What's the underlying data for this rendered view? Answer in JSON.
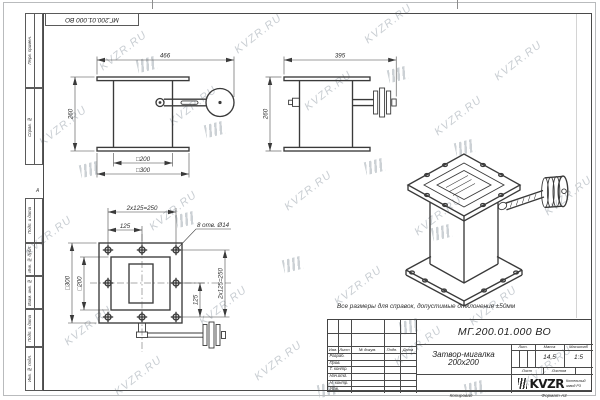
{
  "watermark": {
    "text": "KVZR.RU"
  },
  "stamp_top": {
    "doc_number": "МГ.200.01.000 ВО"
  },
  "margin_labels": {
    "perv_primen": "Перв. примен.",
    "sprav_no": "Справ. №",
    "podp_data": "Подп. и дата",
    "inv_dubl": "Инв. № дубл.",
    "vzam_inv": "Взам. инв. №",
    "inv_podl": "Инв. № подл.",
    "zone": "А"
  },
  "note": "Все размеры для справок, допустимые отклонения ±50мм",
  "views": {
    "front": {
      "dim_total_width": "466",
      "dim_height": "260",
      "dim_body": "□200",
      "dim_flange": "□300"
    },
    "side": {
      "dim_width": "395",
      "dim_height": "260"
    },
    "plan": {
      "dim_bolt_span_top": "2x125=250",
      "dim_bolt_half_top": "125",
      "holes_note": "8 отв. Ø14",
      "dim_flange": "□300",
      "dim_body": "□200",
      "dim_bolt_half_right": "125",
      "dim_bolt_span_right": "2x125=250"
    }
  },
  "title_block": {
    "doc_number": "МГ.200.01.000 ВО",
    "title": "Затвор-мигалка 200x200",
    "columns": {
      "izm": "Изм.",
      "list": "Лист",
      "doc": "№ докум.",
      "podp": "Подп.",
      "data": "Дата"
    },
    "rows": [
      "Разраб.",
      "Пров.",
      "Т. контр.",
      "Нач.отд.",
      "Н. контр.",
      "Утв."
    ],
    "lit_label": "Лит.",
    "mass_label": "Масса",
    "scale_label": "Масштаб",
    "mass": "14,5",
    "scale": "1:5",
    "sheet_label": "Лист",
    "sheets_label": "Листов",
    "org": {
      "logo": "KVZR",
      "name_line1": "Котельный",
      "name_line2": "завод РЗ"
    },
    "footer": {
      "copied": "Копировал",
      "format": "Формат А3"
    }
  }
}
